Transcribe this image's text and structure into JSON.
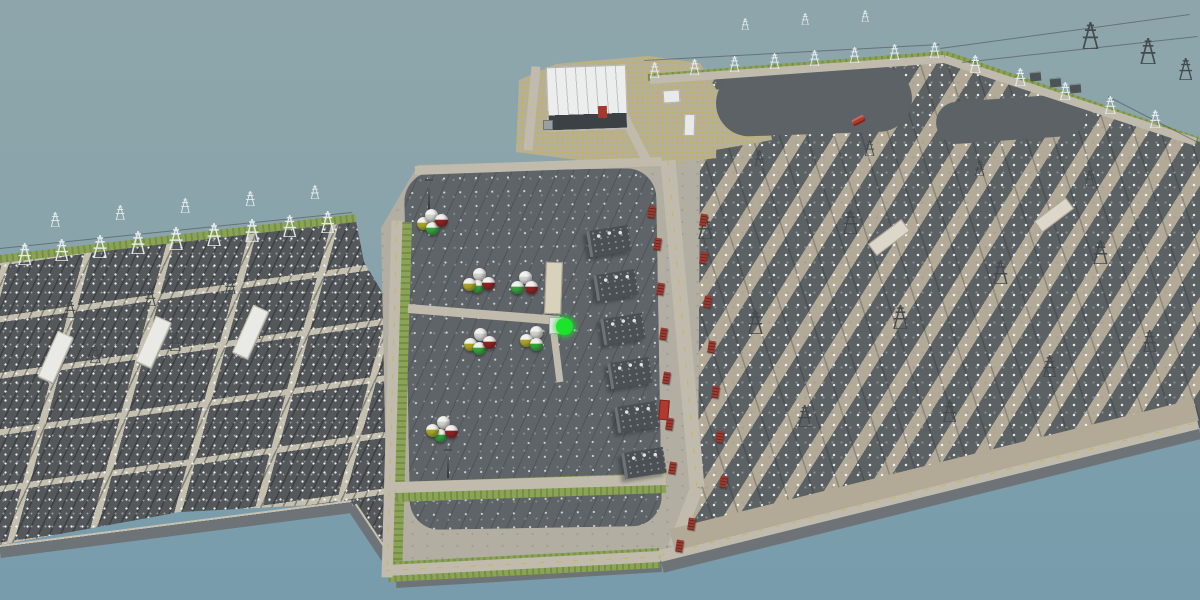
{
  "scene": {
    "description": "Aerial 3D render of a coastal electrical substation complex surrounded by water; no on-screen text or HUD",
    "selected_object": "bright green spherical tank on central equipment pad",
    "colors": {
      "sky_water_top": "#8ea6ab",
      "water": "#7d9fad",
      "yard_dark": "#54585b",
      "yard_mid": "#5c6164",
      "platform_light": "#b2aea2",
      "path_tan": "#b2aa97",
      "road": "#c0bbad",
      "road_centerline": "#c9b45a",
      "gravel_yellow": "#c6b250",
      "grass": "#8aa355",
      "revetment": "#6d7377",
      "roof_white": "#eceded",
      "relay_building": "#dcd7c9",
      "transformer": "#4a5054",
      "red_unit": "#9e3a2f",
      "sphere_white": "#cfcfcb",
      "sphere_green": "#35a23c",
      "sphere_red": "#8e2222",
      "sphere_yellow": "#a8a426",
      "highlight_green": "#1ce32b",
      "vehicle_red": "#b2392e"
    }
  },
  "platforms": [
    {
      "cls": "yard-l",
      "name": "west-switchyard",
      "clip": "0px 262px,356px 221px,364px 262px,394px 312px,404px 575px,352px 503px,180px 512px,0px 545px"
    },
    {
      "cls": "yard-r",
      "name": "east-switchyard",
      "clip": "640px 80px,948px 55px,1200px 142px,1200px 428px,660px 558px"
    },
    {
      "cls": "plat-c",
      "name": "central-platform",
      "clip": "418px 165px,700px 157px,698px 500px,656px 562px,388px 578px,381px 228px"
    },
    {
      "cls": "compound",
      "name": "control-building-compound",
      "clip": "516px 152px,519px 80px,556px 64px,648px 56px,700px 63px,718px 92px,716px 158px,640px 168px"
    },
    {
      "cls": "comp-ext",
      "name": "gravel-compound-extension",
      "clip": "698px 92px,762px 84px,772px 140px,704px 152px"
    }
  ],
  "base_rects": [
    {
      "x": 407,
      "y": 170,
      "w": 252,
      "h": 358,
      "r": -1,
      "cls": "pad",
      "name": "equipment-pad",
      "inter": "false"
    },
    {
      "x": 716,
      "y": 68,
      "w": 196,
      "h": 66,
      "r": -2,
      "cls": "oval",
      "name": "equipment-pad-oval",
      "inter": "false"
    },
    {
      "x": 936,
      "y": 98,
      "w": 150,
      "h": 42,
      "r": -4,
      "cls": "oval",
      "name": "equipment-pad-oval",
      "inter": "false"
    }
  ],
  "revetment": [
    [
      0,
      551,
      352,
      506,
      13
    ],
    [
      352,
      506,
      402,
      581,
      11
    ],
    [
      396,
      581,
      662,
      565,
      13
    ],
    [
      662,
      565,
      1200,
      431,
      15
    ]
  ],
  "grass": [
    [
      0,
      259,
      356,
      218,
      8
    ],
    [
      402,
      222,
      392,
      577,
      20
    ],
    [
      396,
      492,
      666,
      483,
      20
    ],
    [
      388,
      572,
      660,
      558,
      20
    ],
    [
      648,
      77,
      946,
      54,
      7
    ],
    [
      946,
      54,
      1198,
      140,
      7
    ],
    [
      662,
      556,
      1198,
      424,
      9
    ]
  ],
  "roads": [
    [
      397,
      220,
      387,
      577,
      11,
      1
    ],
    [
      415,
      170,
      662,
      161,
      9,
      0
    ],
    [
      614,
      96,
      648,
      163,
      9,
      0
    ],
    [
      668,
      160,
      697,
      487,
      15,
      1
    ],
    [
      697,
      487,
      674,
      547,
      13,
      0
    ],
    [
      395,
      487,
      666,
      479,
      11,
      0
    ],
    [
      408,
      308,
      560,
      320,
      9,
      0
    ],
    [
      552,
      318,
      560,
      382,
      7,
      0
    ],
    [
      386,
      570,
      660,
      556,
      11,
      1
    ],
    [
      660,
      556,
      1198,
      423,
      12,
      1
    ],
    [
      536,
      66,
      528,
      150,
      9,
      0
    ],
    [
      650,
      80,
      944,
      59,
      8,
      0
    ],
    [
      944,
      59,
      1196,
      142,
      8,
      0
    ]
  ],
  "paths": [
    [
      672,
      540,
      1196,
      410,
      22
    ]
  ],
  "powerlines": [
    [
      940,
      48,
      1190,
      14
    ],
    [
      962,
      62,
      1198,
      36
    ],
    [
      644,
      60,
      940,
      44
    ],
    [
      1108,
      96,
      1198,
      142
    ],
    [
      0,
      248,
      352,
      212
    ]
  ],
  "towers": [
    [
      25,
      243,
      22,
      0
    ],
    [
      62,
      239,
      22,
      0
    ],
    [
      100,
      235,
      23,
      0
    ],
    [
      138,
      231,
      23,
      0
    ],
    [
      176,
      227,
      23,
      0
    ],
    [
      214,
      223,
      23,
      0
    ],
    [
      252,
      219,
      23,
      0
    ],
    [
      290,
      215,
      22,
      0
    ],
    [
      328,
      211,
      22,
      0
    ],
    [
      55,
      212,
      15,
      0
    ],
    [
      120,
      205,
      15,
      0
    ],
    [
      185,
      198,
      15,
      0
    ],
    [
      250,
      191,
      15,
      0
    ],
    [
      315,
      185,
      14,
      0
    ],
    [
      70,
      300,
      18,
      1
    ],
    [
      150,
      288,
      18,
      1
    ],
    [
      230,
      276,
      18,
      1
    ],
    [
      95,
      345,
      18,
      1
    ],
    [
      175,
      333,
      18,
      1
    ],
    [
      255,
      321,
      18,
      1
    ],
    [
      655,
      62,
      16,
      0
    ],
    [
      695,
      59,
      16,
      0
    ],
    [
      735,
      56,
      16,
      0
    ],
    [
      775,
      53,
      16,
      0
    ],
    [
      815,
      50,
      16,
      0
    ],
    [
      855,
      47,
      16,
      0
    ],
    [
      895,
      44,
      16,
      0
    ],
    [
      935,
      42,
      16,
      0
    ],
    [
      975,
      55,
      18,
      0
    ],
    [
      1020,
      68,
      18,
      0
    ],
    [
      1065,
      82,
      18,
      0
    ],
    [
      1110,
      96,
      18,
      0
    ],
    [
      1155,
      110,
      18,
      0
    ],
    [
      1090,
      22,
      27,
      1
    ],
    [
      1148,
      38,
      26,
      1
    ],
    [
      1186,
      58,
      22,
      1
    ],
    [
      745,
      18,
      12,
      0
    ],
    [
      805,
      13,
      12,
      0
    ],
    [
      865,
      10,
      12,
      0
    ],
    [
      705,
      215,
      24,
      1
    ],
    [
      755,
      310,
      24,
      1
    ],
    [
      805,
      405,
      22,
      1
    ],
    [
      850,
      210,
      24,
      1
    ],
    [
      900,
      305,
      24,
      1
    ],
    [
      950,
      400,
      22,
      1
    ],
    [
      1000,
      260,
      24,
      1
    ],
    [
      1050,
      355,
      22,
      1
    ],
    [
      1100,
      240,
      24,
      1
    ],
    [
      1150,
      330,
      22,
      1
    ],
    [
      760,
      150,
      16,
      1
    ],
    [
      870,
      140,
      16,
      1
    ],
    [
      980,
      160,
      16,
      1
    ],
    [
      1090,
      170,
      16,
      1
    ]
  ],
  "masts": [
    [
      428,
      176,
      34
    ],
    [
      447,
      446,
      32
    ]
  ],
  "buildings": [
    {
      "x": 547,
      "y": 66,
      "w": 80,
      "h": 64,
      "r": -2,
      "cls": "hall",
      "name": "control-building",
      "inter": "true"
    },
    {
      "x": 598,
      "y": 106,
      "w": 9,
      "h": 12,
      "r": -2,
      "cls": "red-box",
      "name": "red-cabinet",
      "inter": "true"
    },
    {
      "x": 543,
      "y": 120,
      "w": 10,
      "h": 10,
      "r": 0,
      "cls": "gray-shed",
      "name": "storage-shed",
      "inter": "true"
    },
    {
      "x": 663,
      "y": 90,
      "w": 17,
      "h": 13,
      "r": -4,
      "cls": "white-shed",
      "name": "equipment-shed",
      "inter": "true"
    },
    {
      "x": 684,
      "y": 114,
      "w": 11,
      "h": 22,
      "r": 2,
      "cls": "white-shed",
      "name": "equipment-shed",
      "inter": "true"
    },
    {
      "x": 47,
      "y": 332,
      "w": 17,
      "h": 50,
      "r": 24,
      "cls": "left-hall",
      "name": "switchgear-hall",
      "inter": "true"
    },
    {
      "x": 145,
      "y": 317,
      "w": 17,
      "h": 50,
      "r": 24,
      "cls": "left-hall",
      "name": "switchgear-hall",
      "inter": "true"
    },
    {
      "x": 242,
      "y": 306,
      "w": 17,
      "h": 52,
      "r": 24,
      "cls": "left-hall",
      "name": "switchgear-hall",
      "inter": "true"
    },
    {
      "x": 868,
      "y": 230,
      "w": 42,
      "h": 15,
      "r": -37,
      "cls": "relay",
      "name": "relay-building",
      "inter": "true"
    },
    {
      "x": 1034,
      "y": 208,
      "w": 40,
      "h": 14,
      "r": -37,
      "cls": "relay",
      "name": "relay-building",
      "inter": "true"
    },
    {
      "x": 545,
      "y": 262,
      "w": 17,
      "h": 52,
      "r": 2,
      "cls": "aux",
      "name": "auxiliary-building",
      "inter": "true"
    },
    {
      "x": 549,
      "y": 317,
      "w": 15,
      "h": 17,
      "r": 0,
      "cls": "white-shed",
      "name": "equipment-shed",
      "inter": "true"
    },
    {
      "x": 1030,
      "y": 72,
      "w": 11,
      "h": 9,
      "r": -5,
      "cls": "dark-box",
      "name": "box-transformer",
      "inter": "true"
    },
    {
      "x": 1050,
      "y": 78,
      "w": 11,
      "h": 9,
      "r": -5,
      "cls": "dark-box",
      "name": "box-transformer",
      "inter": "true"
    },
    {
      "x": 1070,
      "y": 84,
      "w": 11,
      "h": 9,
      "r": -5,
      "cls": "dark-box",
      "name": "box-transformer",
      "inter": "true"
    },
    {
      "x": 852,
      "y": 117,
      "w": 13,
      "h": 7,
      "r": -28,
      "cls": "veh-car",
      "name": "red-car",
      "inter": "true"
    },
    {
      "x": 659,
      "y": 400,
      "w": 10,
      "h": 20,
      "r": 5,
      "cls": "veh-truck",
      "name": "red-truck",
      "inter": "true"
    }
  ],
  "transformers": [
    [
      588,
      228
    ],
    [
      595,
      272
    ],
    [
      602,
      316
    ],
    [
      609,
      360
    ],
    [
      616,
      404
    ],
    [
      623,
      450
    ]
  ],
  "red_units": [
    [
      654,
      238
    ],
    [
      657,
      283
    ],
    [
      660,
      328
    ],
    [
      663,
      372
    ],
    [
      666,
      418
    ],
    [
      669,
      462
    ],
    [
      700,
      252
    ],
    [
      704,
      296
    ],
    [
      708,
      341
    ],
    [
      712,
      386
    ],
    [
      716,
      431
    ],
    [
      720,
      476
    ],
    [
      688,
      518
    ],
    [
      648,
      206
    ],
    [
      700,
      214
    ],
    [
      676,
      540
    ]
  ],
  "sphere_clusters": [
    {
      "x": 431,
      "y": 221,
      "spheres": [
        [
          "#a8a426",
          -8,
          2
        ],
        [
          "#cfcfcb",
          0,
          -6
        ],
        [
          "#35a23c",
          1,
          7
        ],
        [
          "#8e2222",
          10,
          -1
        ]
      ]
    },
    {
      "x": 479,
      "y": 281,
      "spheres": [
        [
          "#cfcfcb",
          0,
          -7
        ],
        [
          "#35a23c",
          -2,
          5
        ],
        [
          "#a8a426",
          -10,
          3
        ],
        [
          "#8e2222",
          9,
          2
        ]
      ]
    },
    {
      "x": 523,
      "y": 283,
      "spheres": [
        [
          "#cfcfcb",
          2,
          -6
        ],
        [
          "#35a23c",
          -6,
          4
        ],
        [
          "#8e2222",
          8,
          4
        ]
      ]
    },
    {
      "x": 479,
      "y": 341,
      "spheres": [
        [
          "#cfcfcb",
          1,
          -7
        ],
        [
          "#a8a426",
          -9,
          3
        ],
        [
          "#35a23c",
          0,
          7
        ],
        [
          "#8e2222",
          10,
          1
        ]
      ]
    },
    {
      "x": 534,
      "y": 338,
      "spheres": [
        [
          "#cfcfcb",
          2,
          -6
        ],
        [
          "#a8a426",
          -8,
          2
        ],
        [
          "#35a23c",
          2,
          6
        ]
      ]
    },
    {
      "x": 443,
      "y": 429,
      "spheres": [
        [
          "#cfcfcb",
          0,
          -7
        ],
        [
          "#35a23c",
          -3,
          6
        ],
        [
          "#a8a426",
          -11,
          1
        ],
        [
          "#8e2222",
          8,
          2
        ]
      ]
    }
  ],
  "highlight": {
    "x": 564,
    "y": 326
  }
}
